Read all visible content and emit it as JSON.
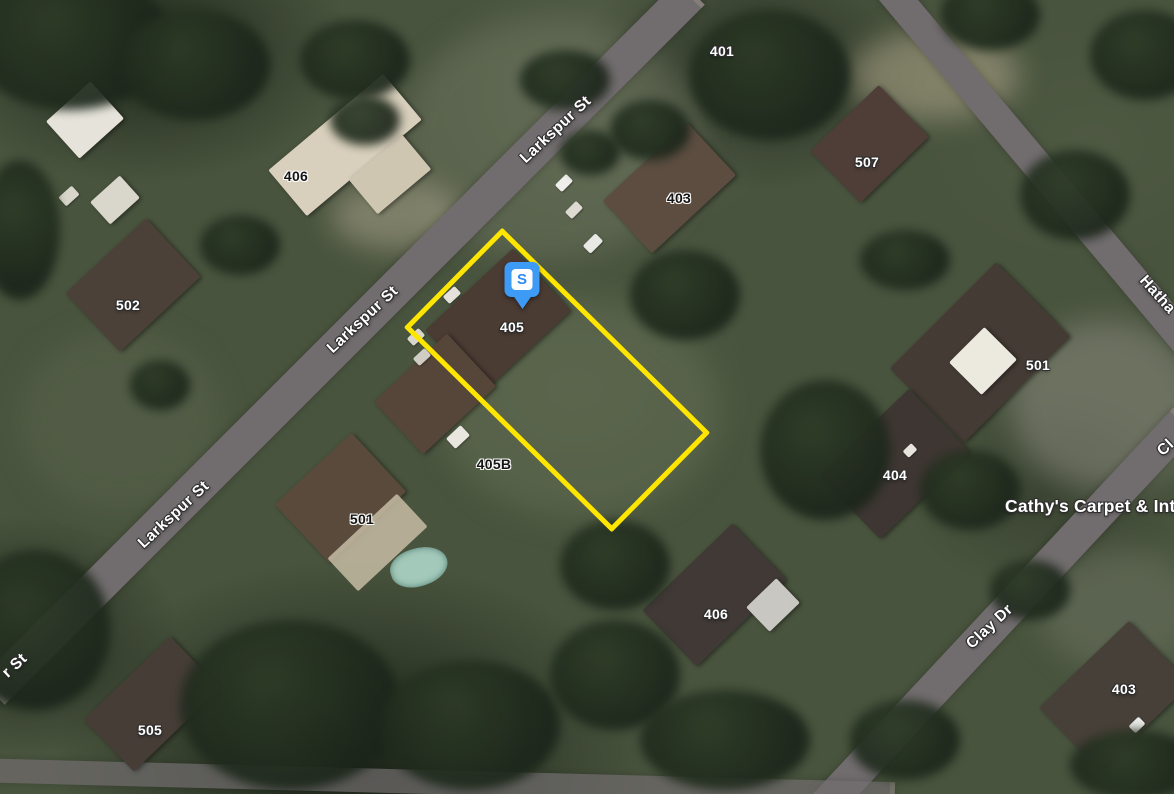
{
  "map": {
    "view_type": "satellite",
    "marker": {
      "letter": "S",
      "pin_color": "#3D9BF5",
      "badge_color": "#FFFFFF",
      "letter_color": "#2E8BF0"
    },
    "parcel": {
      "outline_color": "#FFE600"
    },
    "street_labels": [
      {
        "text": "Larkspur St"
      },
      {
        "text": "Larkspur St"
      },
      {
        "text": "Larkspur St"
      },
      {
        "text": "r St"
      },
      {
        "text": "Hatha"
      },
      {
        "text": "Cl"
      },
      {
        "text": "Clay Dr"
      }
    ],
    "place_labels": [
      {
        "text": "Cathy's Carpet & Int"
      }
    ],
    "address_labels": [
      {
        "text": "401"
      },
      {
        "text": "406"
      },
      {
        "text": "403"
      },
      {
        "text": "507"
      },
      {
        "text": "502"
      },
      {
        "text": "405"
      },
      {
        "text": "501"
      },
      {
        "text": "404"
      },
      {
        "text": "405B"
      },
      {
        "text": "501"
      },
      {
        "text": "406"
      },
      {
        "text": "403"
      },
      {
        "text": "505"
      }
    ]
  }
}
